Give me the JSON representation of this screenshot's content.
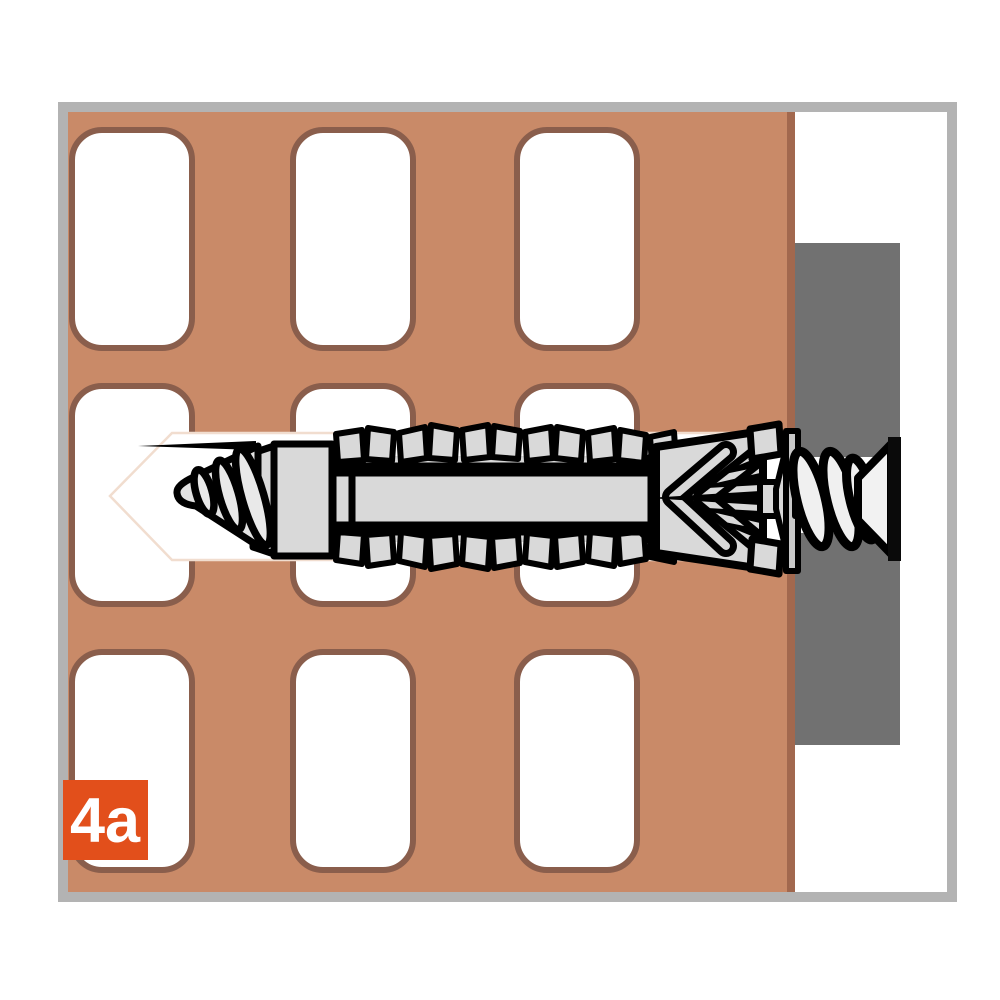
{
  "figure": {
    "step_label": "4a"
  },
  "colors": {
    "background": "#ffffff",
    "frame": "#b3b3b3",
    "brick": "#c98a68",
    "brick_edge": "#a2684e",
    "hole_fill": "#ffffff",
    "hole_stroke": "#8a5e4c",
    "channel_fill": "#ffffff",
    "channel_stroke": "#f1ddcf",
    "fixture_panel": "#717171",
    "fixture_hole": "#ffffff",
    "plug_fill": "#d9d9d9",
    "screw_fill": "#ededed",
    "screw_tip_fill": "#e2e2e2",
    "thread_fill": "#f0f0f0",
    "head_fill": "#f2f2f2",
    "outline": "#000000",
    "label_bg": "#e24f1b",
    "label_text": "#ffffff"
  }
}
